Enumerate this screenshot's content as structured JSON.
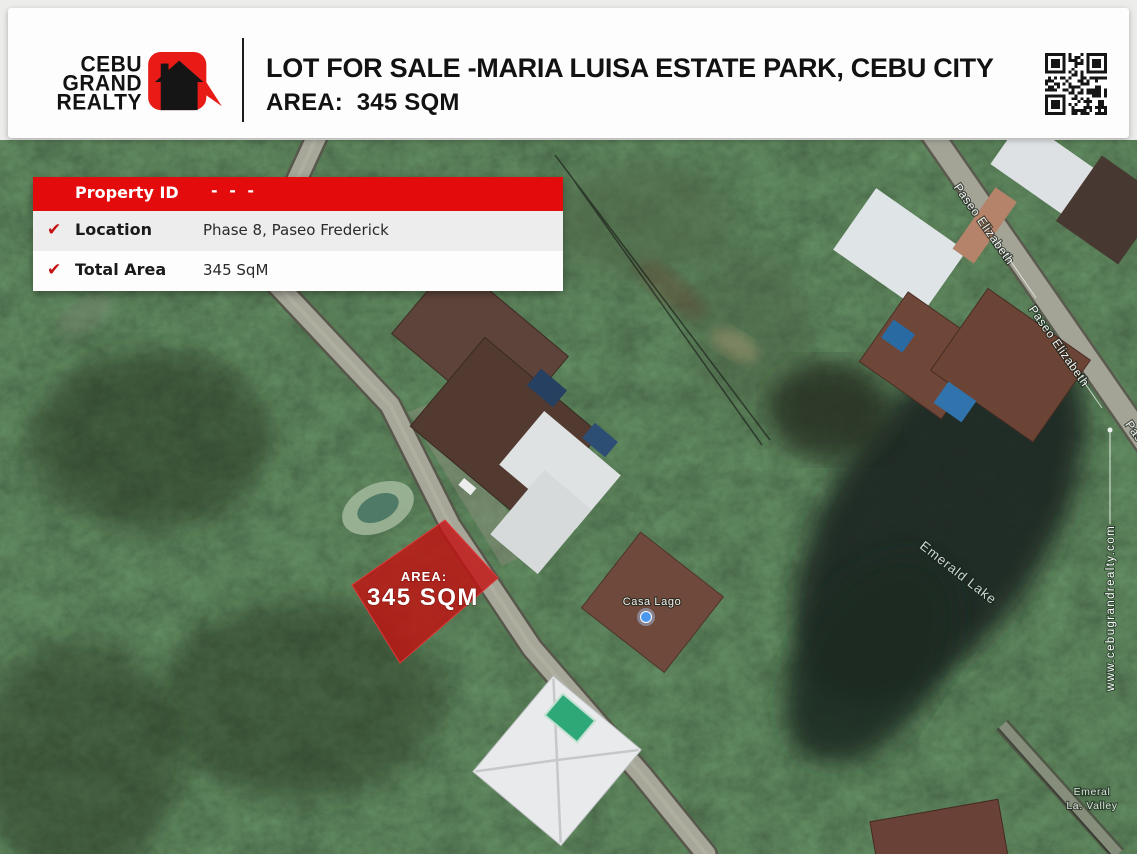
{
  "header": {
    "logo_lines": [
      "CEBU",
      "GRAND",
      "REALTY"
    ],
    "brand_red": "#e81b17",
    "title": "LOT FOR SALE -MARIA LUISA ESTATE PARK, CEBU CITY",
    "subtitle": "AREA:  345 SQM"
  },
  "property_card": {
    "header_label": "Property ID",
    "header_value": "- - -",
    "check_icon": "✔",
    "accent_red": "#e30b0b",
    "check_color": "#c41212",
    "rows": [
      {
        "label": "Location",
        "value": "Phase 8, Paseo Frederick"
      },
      {
        "label": "Total Area",
        "value": "345 SqM"
      }
    ]
  },
  "map": {
    "lot": {
      "area_label": "AREA:",
      "area_value": "345 SQM",
      "fill": "#c31010"
    },
    "labels": {
      "road": "Paseo Elizabeth",
      "lake": "Emerald Lake",
      "poi": "Casa Lago",
      "corner_line1": "Emeral",
      "corner_line2": "La. Valley",
      "watermark": "www.cebugrandrealty.com"
    }
  }
}
